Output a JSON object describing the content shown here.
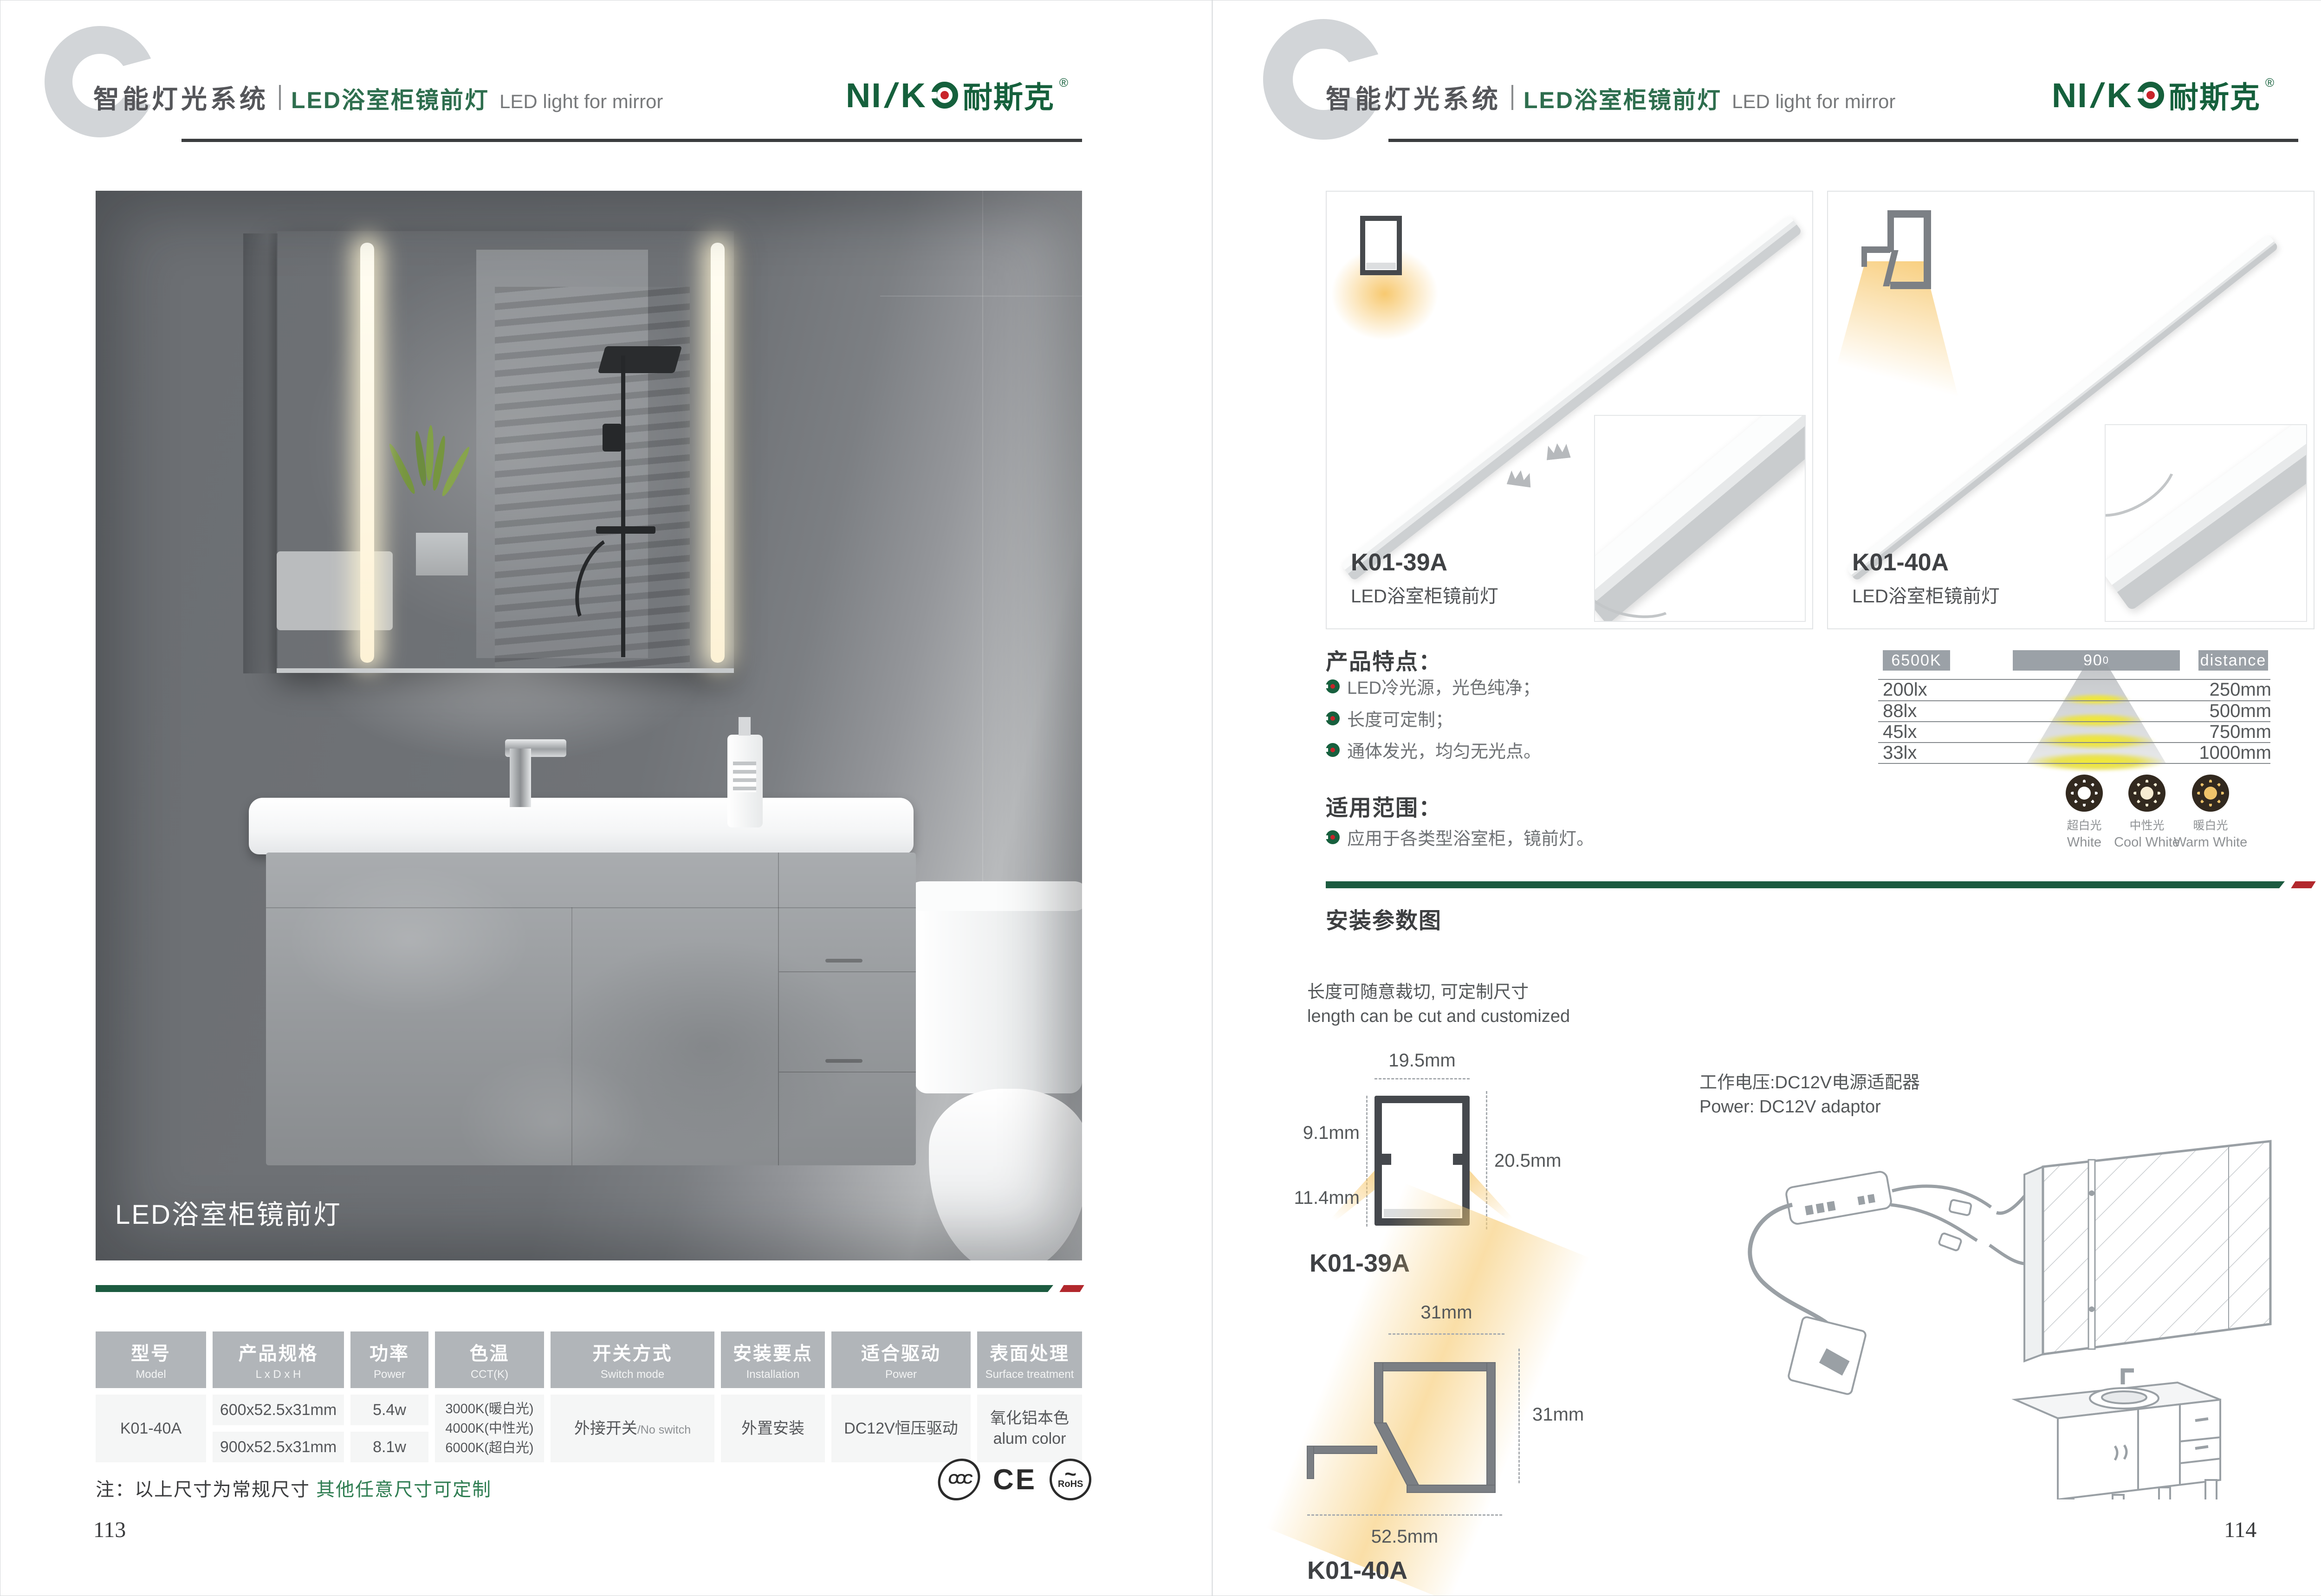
{
  "brand": {
    "latin_prefix": "NI",
    "slash": "/",
    "latin_suffix": "K",
    "cn": "耐斯克",
    "reg": "®"
  },
  "header": {
    "system": "智能灯光系统",
    "title_cn": "LED浴室柜镜前灯",
    "title_en": "LED light for mirror"
  },
  "colors": {
    "brand_green": "#15603c",
    "divider_green": "#1c5b40",
    "divider_red": "#b2282d",
    "table_header_gray": "#b1b5b9",
    "warm_glow": "#f7c668"
  },
  "left_page": {
    "photo_caption": "LED浴室柜镜前灯",
    "table": {
      "h1": {
        "cn": "型号",
        "en": "Model"
      },
      "h2": {
        "cn": "产品规格",
        "en": "L x D x H"
      },
      "h3": {
        "cn": "功率",
        "en": "Power"
      },
      "h4": {
        "cn": "色温",
        "en": "CCT(K)"
      },
      "h5": {
        "cn": "开关方式",
        "en": "Switch mode"
      },
      "h6": {
        "cn": "安装要点",
        "en": "Installation"
      },
      "h7": {
        "cn": "适合驱动",
        "en": "Power"
      },
      "h8": {
        "cn": "表面处理",
        "en": "Surface treatment"
      },
      "row": {
        "model": "K01-40A",
        "spec1": "600x52.5x31mm",
        "spec2": "900x52.5x31mm",
        "power1": "5.4w",
        "power2": "8.1w",
        "cct1": "3000K(暖白光)",
        "cct2": "4000K(中性光)",
        "cct3": "6000K(超白光)",
        "switch_cn": "外接开关",
        "switch_en": "/No switch",
        "install": "外置安装",
        "driver": "DC12V恒压驱动",
        "surface_cn": "氧化铝本色",
        "surface_en": "alum color"
      }
    },
    "note_prefix": "注：以上尺寸为常规尺寸 ",
    "note_highlight": "其他任意尺寸可定制",
    "certs": {
      "c1": "CCC",
      "c2": "CE",
      "c3": "RoHS"
    },
    "page_number": "113"
  },
  "right_page": {
    "products": {
      "p1": {
        "model": "K01-39A",
        "name": "LED浴室柜镜前灯"
      },
      "p2": {
        "model": "K01-40A",
        "name": "LED浴室柜镜前灯"
      }
    },
    "features": {
      "title": "产品特点：",
      "i1": "LED冷光源，光色纯净；",
      "i2": "长度可定制；",
      "i3": "通体发光，均匀无光点。"
    },
    "scope": {
      "title": "适用范围：",
      "i1": "应用于各类型浴室柜，镜前灯。"
    },
    "photometry": {
      "cct": "6500K",
      "angle": "90",
      "angle_sup": "0",
      "distance_label": "distance",
      "r1_lux": "200lx",
      "r1_d": "250mm",
      "r2_lux": "88lx",
      "r2_d": "500mm",
      "r3_lux": "45lx",
      "r3_d": "750mm",
      "r4_lux": "33lx",
      "r4_d": "1000mm"
    },
    "cct_options": {
      "o1": {
        "cn": "超白光",
        "en": "White"
      },
      "o2": {
        "cn": "中性光",
        "en": "Cool White"
      },
      "o3": {
        "cn": "暖白光",
        "en": "Warm White"
      }
    },
    "install": {
      "title": "安装参数图",
      "cut_cn": "长度可随意裁切, 可定制尺寸",
      "cut_en": "length can be cut and customized",
      "power_cn": "工作电压:DC12V电源适配器",
      "power_en": "Power: DC12V adaptor",
      "p1": {
        "model": "K01-39A",
        "top": "19.5mm",
        "upper": "9.1mm",
        "lower": "11.4mm",
        "height": "20.5mm"
      },
      "p2": {
        "model": "K01-40A",
        "top": "31mm",
        "side": "31mm",
        "bottom": "52.5mm"
      }
    },
    "page_number": "114"
  }
}
